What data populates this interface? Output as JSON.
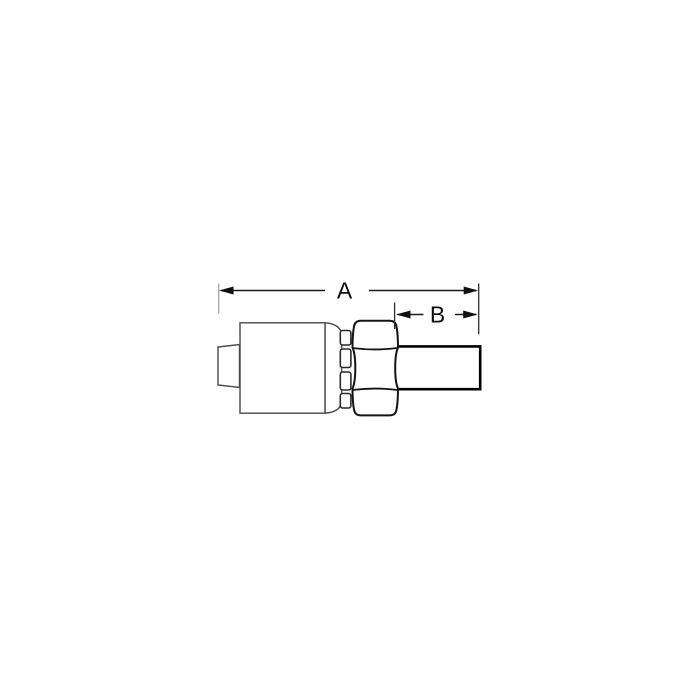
{
  "diagram": {
    "kind": "technical-line-drawing",
    "subject": "crimp hose fitting side view: hose nipple, crimp shell with serrated collar, hex nut, straight tube end",
    "labels": {
      "dim_a": "A",
      "dim_b": "B"
    },
    "colors": {
      "background": "#ffffff",
      "outline": "#1a1a1a",
      "medium_outline": "#4a4a4a",
      "extension_line_gray": "#a6a6a6"
    }
  }
}
